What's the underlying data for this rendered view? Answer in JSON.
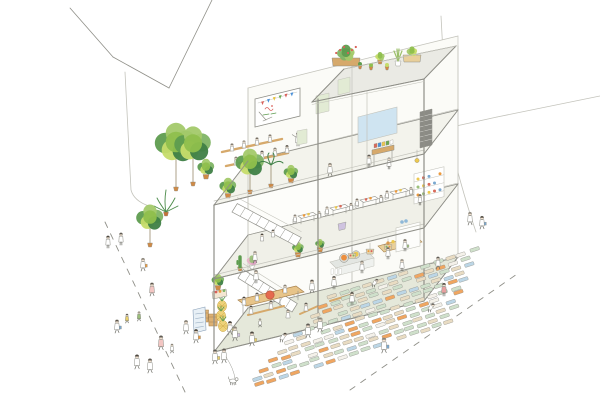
{
  "scene": {
    "kind": "hand-drawn axonometric cutaway illustration",
    "subject": "three-storey open-frame community greenhouse building with rooftop planters, open-air terrace workshop, cafe floor, ground-floor greengrocer kitchen, street plant market and pedestrian crowds",
    "background": "#ffffff"
  },
  "palette": {
    "line": "#8f8f88",
    "lineLight": "#c3c3bb",
    "legs": "#6f6f68",
    "skin": "#f3e2d0",
    "white": "#ffffff",
    "hair": [
      "#5f5b54",
      "#8b857a",
      "#4c473f"
    ],
    "groundSlab": "#e5e8da",
    "midSlab": "#f0f0e8",
    "topSlab": "#f3f3ec",
    "deck": "#eaeae4",
    "wall": "#fbfbf7",
    "greens": [
      "#5e9c4f",
      "#7fb465",
      "#a3c96a",
      "#c6dc6a",
      "#3f7f46",
      "#8fbf4d"
    ],
    "fernGreen": "#4c8c4a",
    "trunk": "#8a7a58",
    "pot": "#d08a45",
    "wood": "#d6a96b",
    "woodLight": "#e8cf9a",
    "woodDark": "#a8824e",
    "steel": "#e3e6e2",
    "orange": "#ec9a3d",
    "red": "#d9605a",
    "yellow": "#ecc84f",
    "pineapple": "#eed27a",
    "pineappleLine": "#c9a23f",
    "screenBlue": "#cfe4f1",
    "bottleBlue": "#8fb8d8",
    "panelGreen": "#e2ebd4",
    "posterBlue": "#e8f0f6",
    "posterInk": "#8aa0b8",
    "lavender": "#cfc3e0",
    "pinkLeaf": "#e8b4c8",
    "hatch": "#8b8b85"
  },
  "bunting_colors": [
    "#d9605a",
    "#4a90d9",
    "#e8c43c",
    "#6aa84f",
    "#d9605a",
    "#4a90d9"
  ],
  "book_colors": [
    "#d96a5a",
    "#4a90d9",
    "#ecc84f",
    "#6aa84f",
    "#ffffff"
  ],
  "dish_colors": [
    "#ecc84f",
    "#d96a5a",
    "#7aa8d0",
    "#ffffff",
    "#ec9a3d",
    "#9bc07a"
  ],
  "plate_colors": [
    "#ec9a3d",
    "#ecc84f",
    "#d96a5a"
  ],
  "roof_planters": [
    [
      "box",
      346,
      66,
      28
    ],
    [
      "pot",
      360,
      69,
      0
    ],
    [
      "pot",
      371,
      70,
      0
    ],
    [
      "bush",
      380,
      64,
      12
    ],
    [
      "pot",
      387,
      70,
      0
    ],
    [
      "aloe",
      398,
      66,
      10
    ],
    [
      "box2",
      412,
      62,
      18
    ]
  ],
  "plants": [
    [
      "tree",
      176,
      191,
      52
    ],
    [
      "tree",
      193,
      186,
      46
    ],
    [
      "bush",
      206,
      179,
      16
    ],
    [
      "fern",
      166,
      216,
      22
    ],
    [
      "bush",
      228,
      198,
      16
    ],
    [
      "tree",
      250,
      194,
      36
    ],
    [
      "palm",
      271,
      188,
      30
    ],
    [
      "bush",
      291,
      183,
      14
    ],
    [
      "tree",
      150,
      247,
      34
    ],
    [
      "bush",
      298,
      257,
      11
    ],
    [
      "cactus",
      240,
      271,
      10
    ],
    [
      "pink",
      252,
      269,
      10
    ],
    [
      "bush",
      320,
      252,
      9
    ],
    [
      "bush",
      218,
      290,
      12
    ]
  ],
  "cafe_tables": [
    [
      306,
      216
    ],
    [
      338,
      208
    ],
    [
      368,
      200
    ],
    [
      398,
      192
    ]
  ],
  "figures": {
    "workshop": [
      [
        232,
        151,
        0.72,
        "sit",
        "",
        ""
      ],
      [
        244,
        148,
        0.72,
        "sit",
        "",
        ""
      ],
      [
        257,
        145,
        0.72,
        "sit",
        "",
        ""
      ],
      [
        270,
        142,
        0.72,
        "sit",
        "",
        ""
      ],
      [
        236,
        165,
        0.78,
        "sit",
        "",
        ""
      ],
      [
        249,
        162,
        0.78,
        "sit",
        "",
        ""
      ],
      [
        262,
        159,
        0.78,
        "sit",
        "",
        ""
      ],
      [
        275,
        156,
        0.78,
        "sit",
        "",
        ""
      ],
      [
        287,
        153,
        0.75,
        "sit",
        "",
        ""
      ],
      [
        298,
        146,
        0.9,
        "point",
        "",
        ""
      ],
      [
        330,
        176,
        0.85,
        "walk",
        "",
        ""
      ]
    ],
    "studio": [
      [
        369,
        167,
        0.8,
        "stand",
        "",
        ""
      ],
      [
        389,
        169,
        0.75,
        "stand",
        "",
        ""
      ]
    ],
    "cafe": [
      [
        262,
        241,
        0.7,
        "sit",
        "",
        ""
      ],
      [
        273,
        237,
        0.7,
        "sit",
        "",
        ""
      ],
      [
        255,
        263,
        0.78,
        "walk",
        "",
        ""
      ],
      [
        420,
        205,
        0.7,
        "stand",
        "",
        ""
      ]
    ],
    "market": [
      [
        244,
        305,
        0.78,
        "sit",
        "",
        ""
      ],
      [
        257,
        301,
        0.78,
        "sit",
        "",
        ""
      ],
      [
        285,
        293,
        0.78,
        "sit",
        "",
        ""
      ],
      [
        251,
        314,
        0.78,
        "sit",
        "",
        ""
      ],
      [
        271,
        309,
        0.78,
        "sit",
        "",
        ""
      ],
      [
        256,
        283,
        0.85,
        "stand",
        "",
        ""
      ],
      [
        312,
        293,
        0.88,
        "walk",
        "",
        ""
      ],
      [
        334,
        289,
        0.85,
        "stand",
        "",
        ""
      ],
      [
        362,
        273,
        0.8,
        "stand",
        "",
        ""
      ],
      [
        388,
        259,
        0.78,
        "stand",
        "",
        ""
      ],
      [
        405,
        251,
        0.78,
        "stand",
        "",
        "#9bc07a"
      ],
      [
        260,
        327,
        0.55,
        "walk",
        "",
        ""
      ],
      [
        230,
        335,
        0.9,
        "walk",
        "",
        "#e9cf6b"
      ],
      [
        306,
        311,
        0.78,
        "sit",
        "",
        ""
      ],
      [
        288,
        318,
        0.8,
        "sit",
        "",
        ""
      ]
    ],
    "field": [
      [
        282,
        342,
        0.9,
        "bend",
        "",
        ""
      ],
      [
        308,
        338,
        0.95,
        "walk",
        "",
        ""
      ],
      [
        320,
        332,
        0.95,
        "walk",
        "",
        ""
      ],
      [
        352,
        305,
        0.85,
        "stand",
        "",
        ""
      ],
      [
        374,
        287,
        0.8,
        "bend",
        "",
        ""
      ],
      [
        402,
        271,
        0.78,
        "stand",
        "",
        ""
      ],
      [
        444,
        296,
        0.85,
        "stand",
        "#e8a0a0",
        ""
      ],
      [
        430,
        312,
        0.85,
        "bend",
        "",
        ""
      ]
    ],
    "crowd": [
      [
        108,
        248,
        0.8,
        "stand",
        "",
        ""
      ],
      [
        121,
        245,
        0.8,
        "stand",
        "",
        ""
      ],
      [
        143,
        271,
        0.85,
        "walk",
        "",
        "#ec9a3d"
      ],
      [
        152,
        296,
        0.88,
        "walk",
        "#f3c6c3",
        ""
      ],
      [
        127,
        323,
        0.6,
        "walk",
        "#e9cf6b",
        ""
      ],
      [
        139,
        321,
        0.62,
        "walk",
        "#9bc07a",
        ""
      ],
      [
        117,
        333,
        0.88,
        "walk",
        "",
        "#7aa8d0"
      ],
      [
        161,
        350,
        0.95,
        "walk",
        "#f3c6c3",
        ""
      ],
      [
        172,
        353,
        0.6,
        "walk",
        "",
        ""
      ],
      [
        137,
        369,
        0.95,
        "walk",
        "",
        ""
      ],
      [
        150,
        373,
        0.95,
        "walk",
        "",
        ""
      ],
      [
        186,
        334,
        0.9,
        "walk",
        "",
        ""
      ],
      [
        196,
        343,
        0.9,
        "walk",
        "",
        "#ec9a3d"
      ],
      [
        215,
        364,
        0.95,
        "walk",
        "",
        "#e9cf6b"
      ],
      [
        235,
        341,
        0.95,
        "walk",
        "",
        "#cfc3e0"
      ],
      [
        252,
        346,
        0.95,
        "walk",
        "",
        "#e9cf6b"
      ],
      [
        224,
        363,
        0.95,
        "walk",
        "",
        ""
      ],
      [
        470,
        225,
        0.85,
        "walk",
        "",
        ""
      ],
      [
        482,
        229,
        0.85,
        "walk",
        "",
        "#7aa8d0"
      ],
      [
        438,
        269,
        0.8,
        "walk",
        "",
        ""
      ],
      [
        384,
        353,
        1.0,
        "walk",
        "",
        "#7aa8d0"
      ]
    ]
  },
  "dog": {
    "x": 233,
    "y": 381
  },
  "pallet_field": {
    "rows": 11,
    "row_origin": [
      248,
      388
    ],
    "row_step": [
      8.4,
      -9.1
    ],
    "col_step": [
      11.8,
      -3.9
    ],
    "cols_base": 17,
    "cols_shrink": 0.55,
    "skip_chance": 0.07,
    "size": [
      9.5,
      3.4
    ],
    "angle": -18,
    "colors": [
      "#cfe0cb",
      "#e9dcc3",
      "#f0a661",
      "#bcd6e6",
      "#f4f1ea"
    ],
    "weights": [
      0.38,
      0.64,
      0.79,
      0.9,
      1.0
    ]
  }
}
